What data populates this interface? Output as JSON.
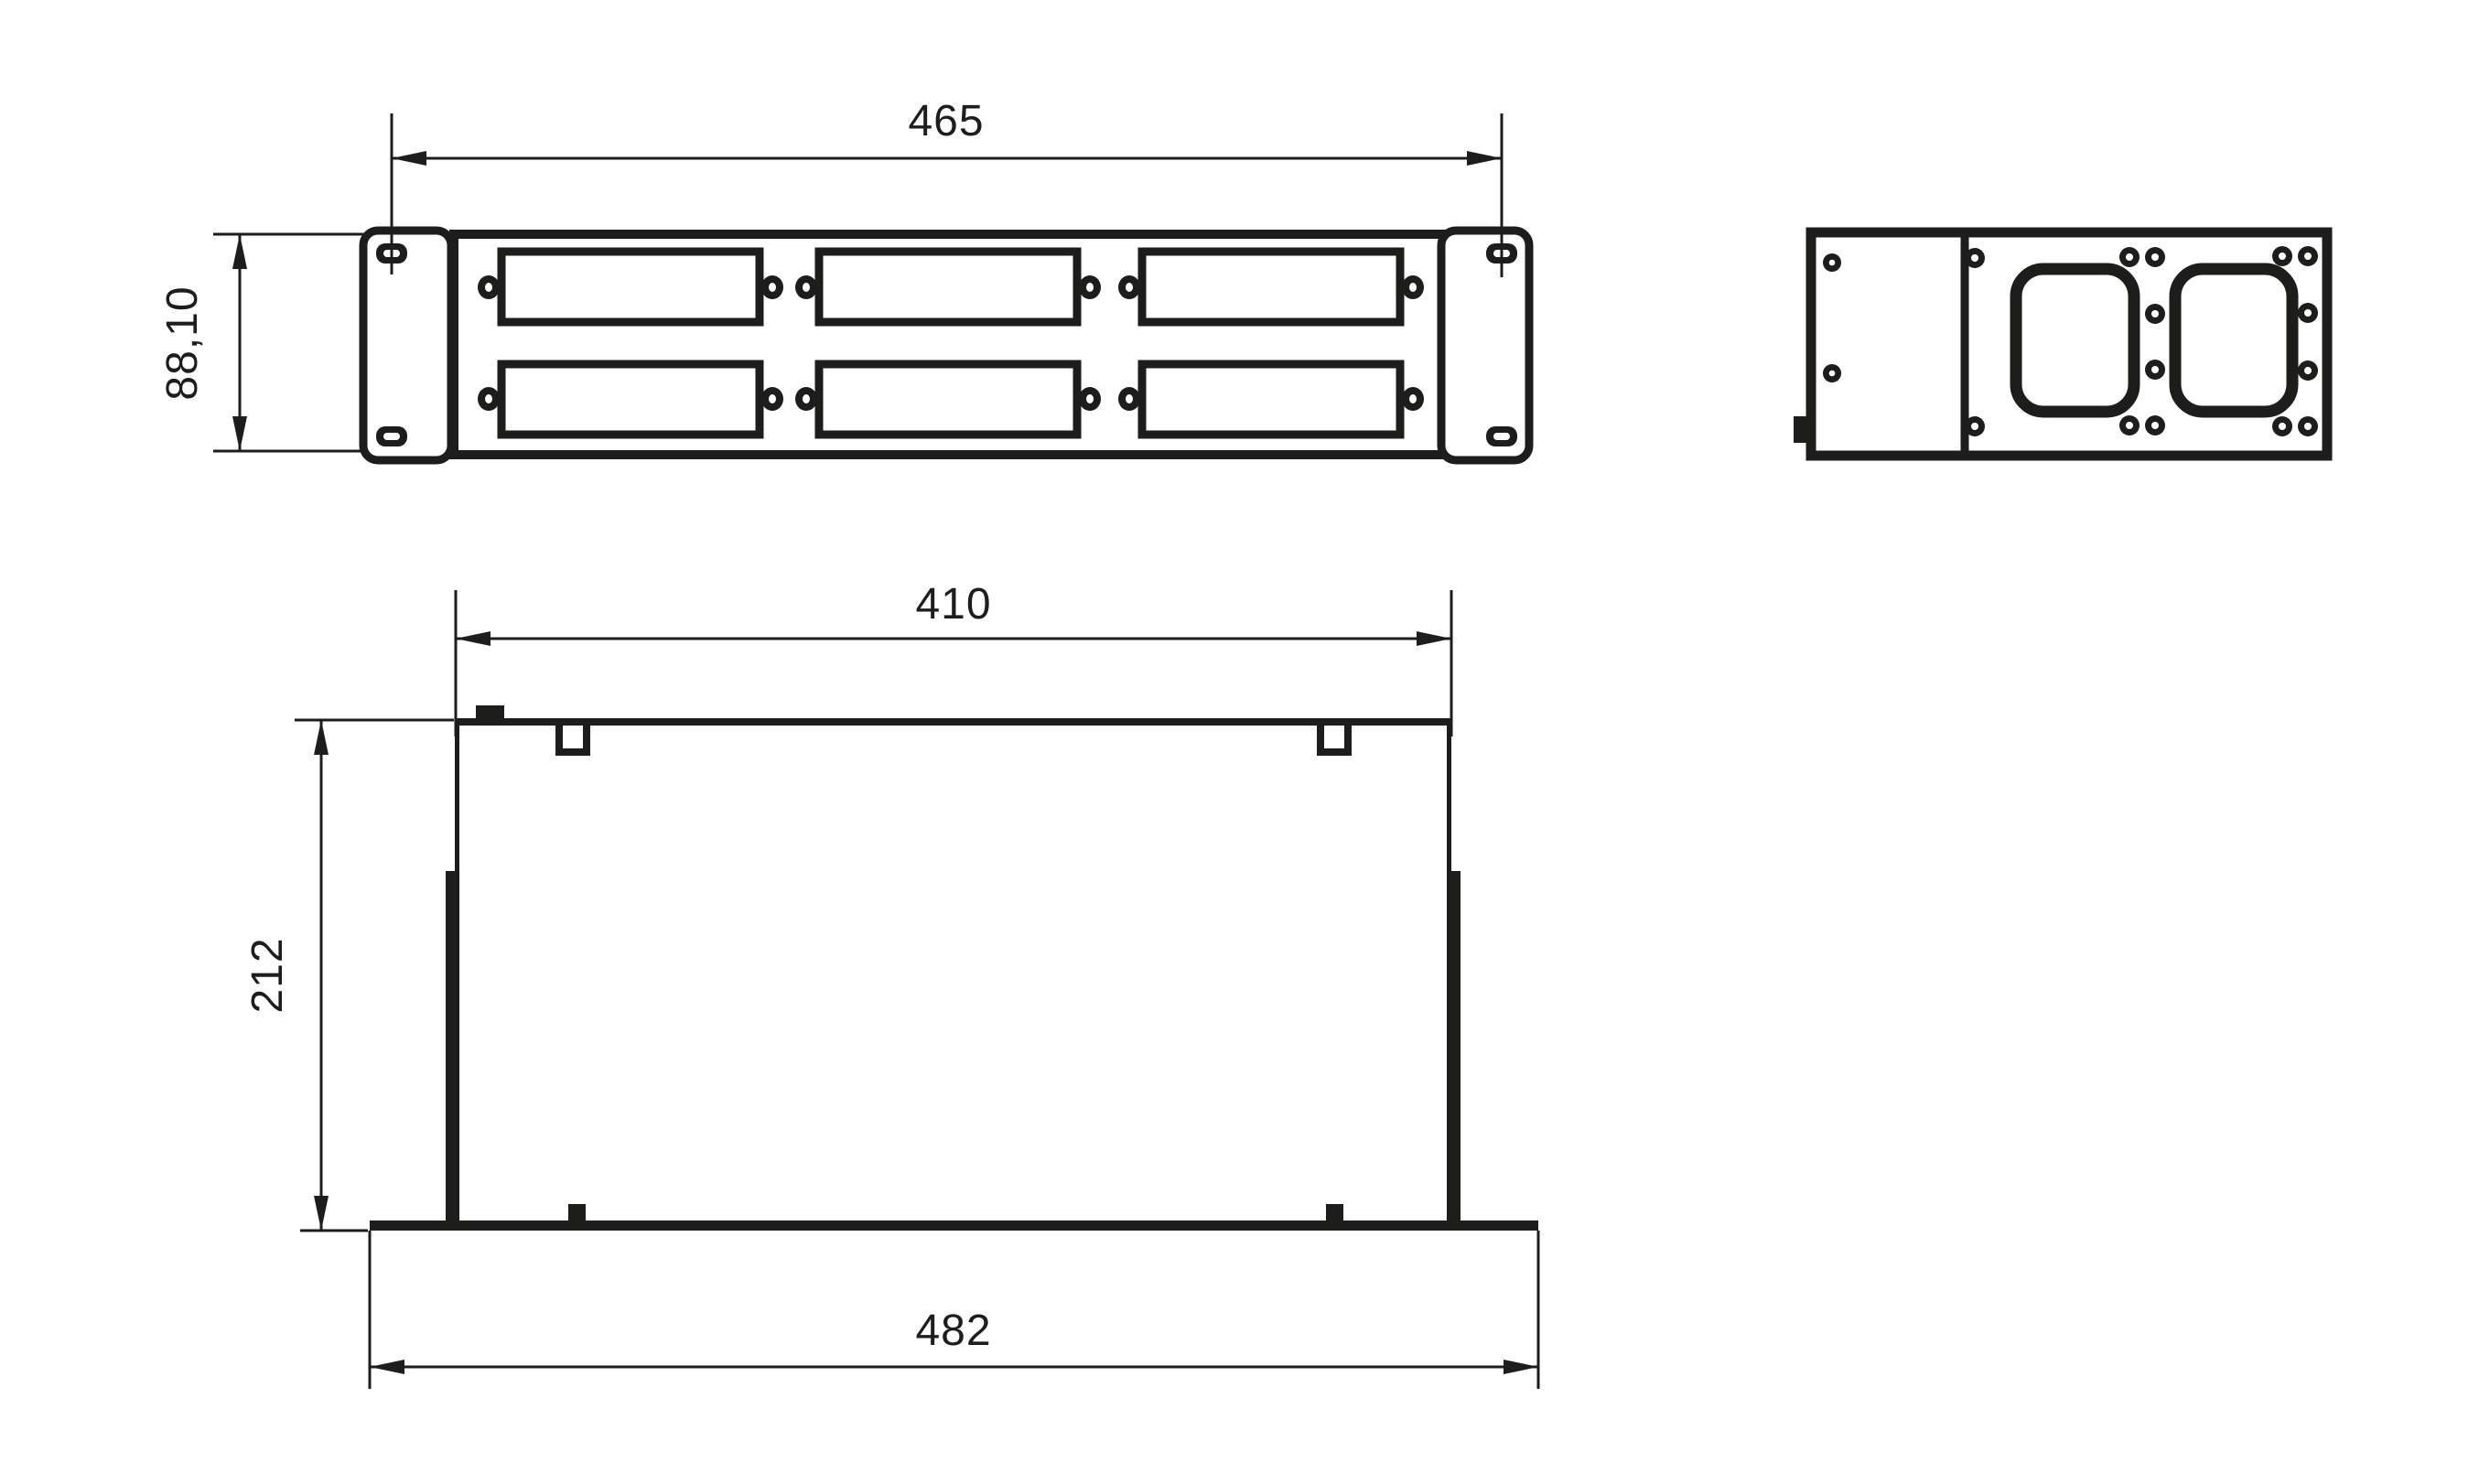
{
  "drawing": {
    "colors": {
      "line": "#1d1d1b",
      "background": "#ffffff"
    },
    "front_view": {
      "width_dim": "465",
      "height_dim": "88,10"
    },
    "plan_view": {
      "inner_width_dim": "410",
      "depth_dim": "212",
      "overall_width_dim": "482"
    }
  }
}
